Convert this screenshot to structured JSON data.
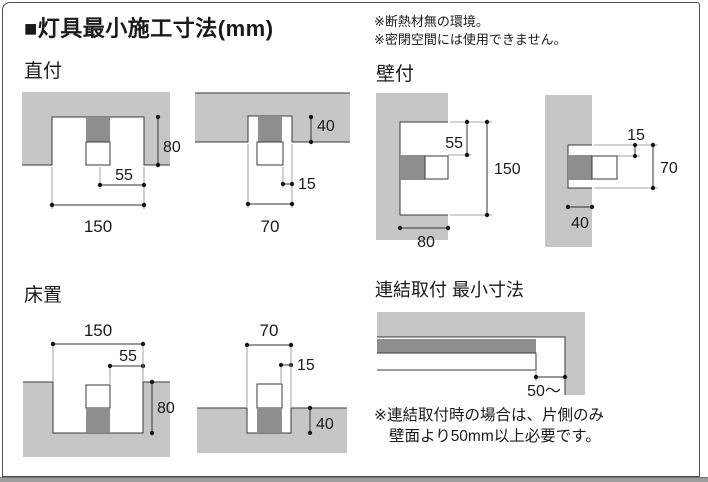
{
  "title": "■灯具最小施工寸法(mm)",
  "header_notes": {
    "line1": "※断熱材無の環境。",
    "line2": "※密閉空間には使用できません。"
  },
  "colors": {
    "structure_gray": "#c6c6c6",
    "fixture_gray": "#8e8e8e",
    "line": "#3a3a3a",
    "bottom_strip": "#9c9c9c"
  },
  "sections": {
    "chokuzuke": {
      "label": "直付",
      "left": {
        "width": "150",
        "offset": "55",
        "depth": "80"
      },
      "right": {
        "width": "70",
        "offset": "15",
        "depth": "40"
      }
    },
    "kabezuke": {
      "label": "壁付",
      "left": {
        "offset": "55",
        "height": "150",
        "width": "80"
      },
      "right": {
        "offset": "15",
        "height": "70",
        "depth": "40"
      }
    },
    "yukaoki": {
      "label": "床置",
      "left": {
        "width": "150",
        "offset": "55",
        "depth": "80"
      },
      "right": {
        "width": "70",
        "offset": "15",
        "depth": "40"
      }
    },
    "renketsu": {
      "label": "連結取付 最小寸法",
      "clearance": "50〜",
      "note_line1": "※連結取付時の場合は、片側のみ",
      "note_line2": "壁面より50mm以上必要です。"
    }
  }
}
